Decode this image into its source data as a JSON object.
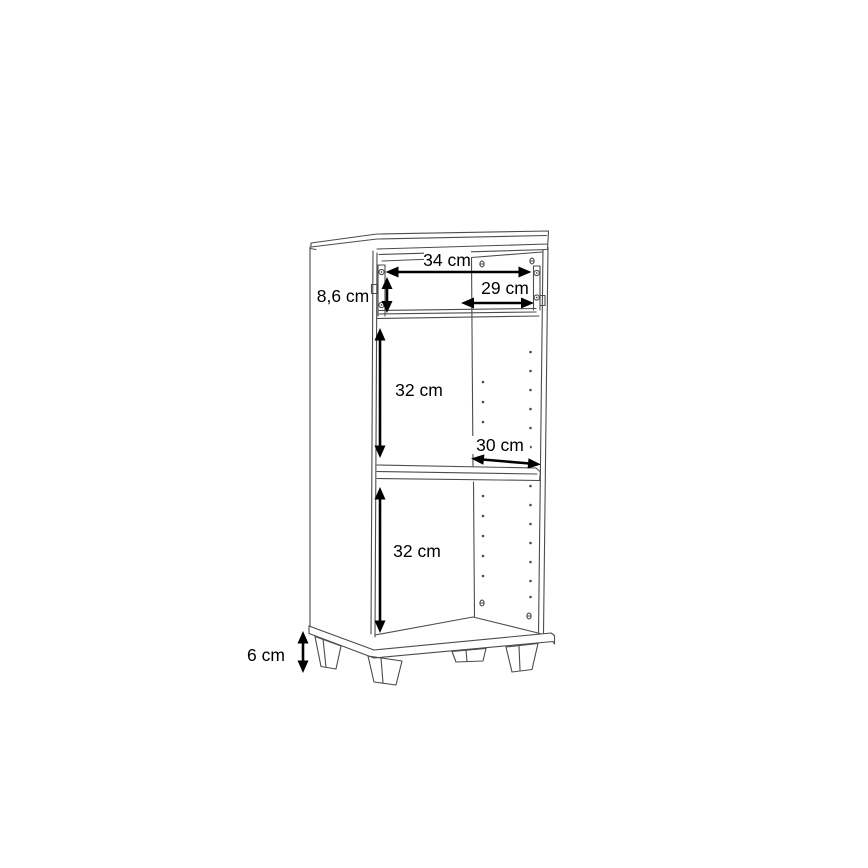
{
  "diagram": {
    "type": "furniture-dimension-drawing",
    "subject": "narrow cabinet with drawer section, adjustable shelf and four feet",
    "background": "#ffffff",
    "line_color": "#4c4c4c",
    "dimension_color": "#000000",
    "dimensions": {
      "inner_width": "34 cm",
      "top_depth": "29 cm",
      "drawer_section_height": "8,6 cm",
      "upper_section_height": "32 cm",
      "shelf_depth": "30 cm",
      "lower_section_height": "32 cm",
      "feet_height": "6 cm"
    }
  }
}
